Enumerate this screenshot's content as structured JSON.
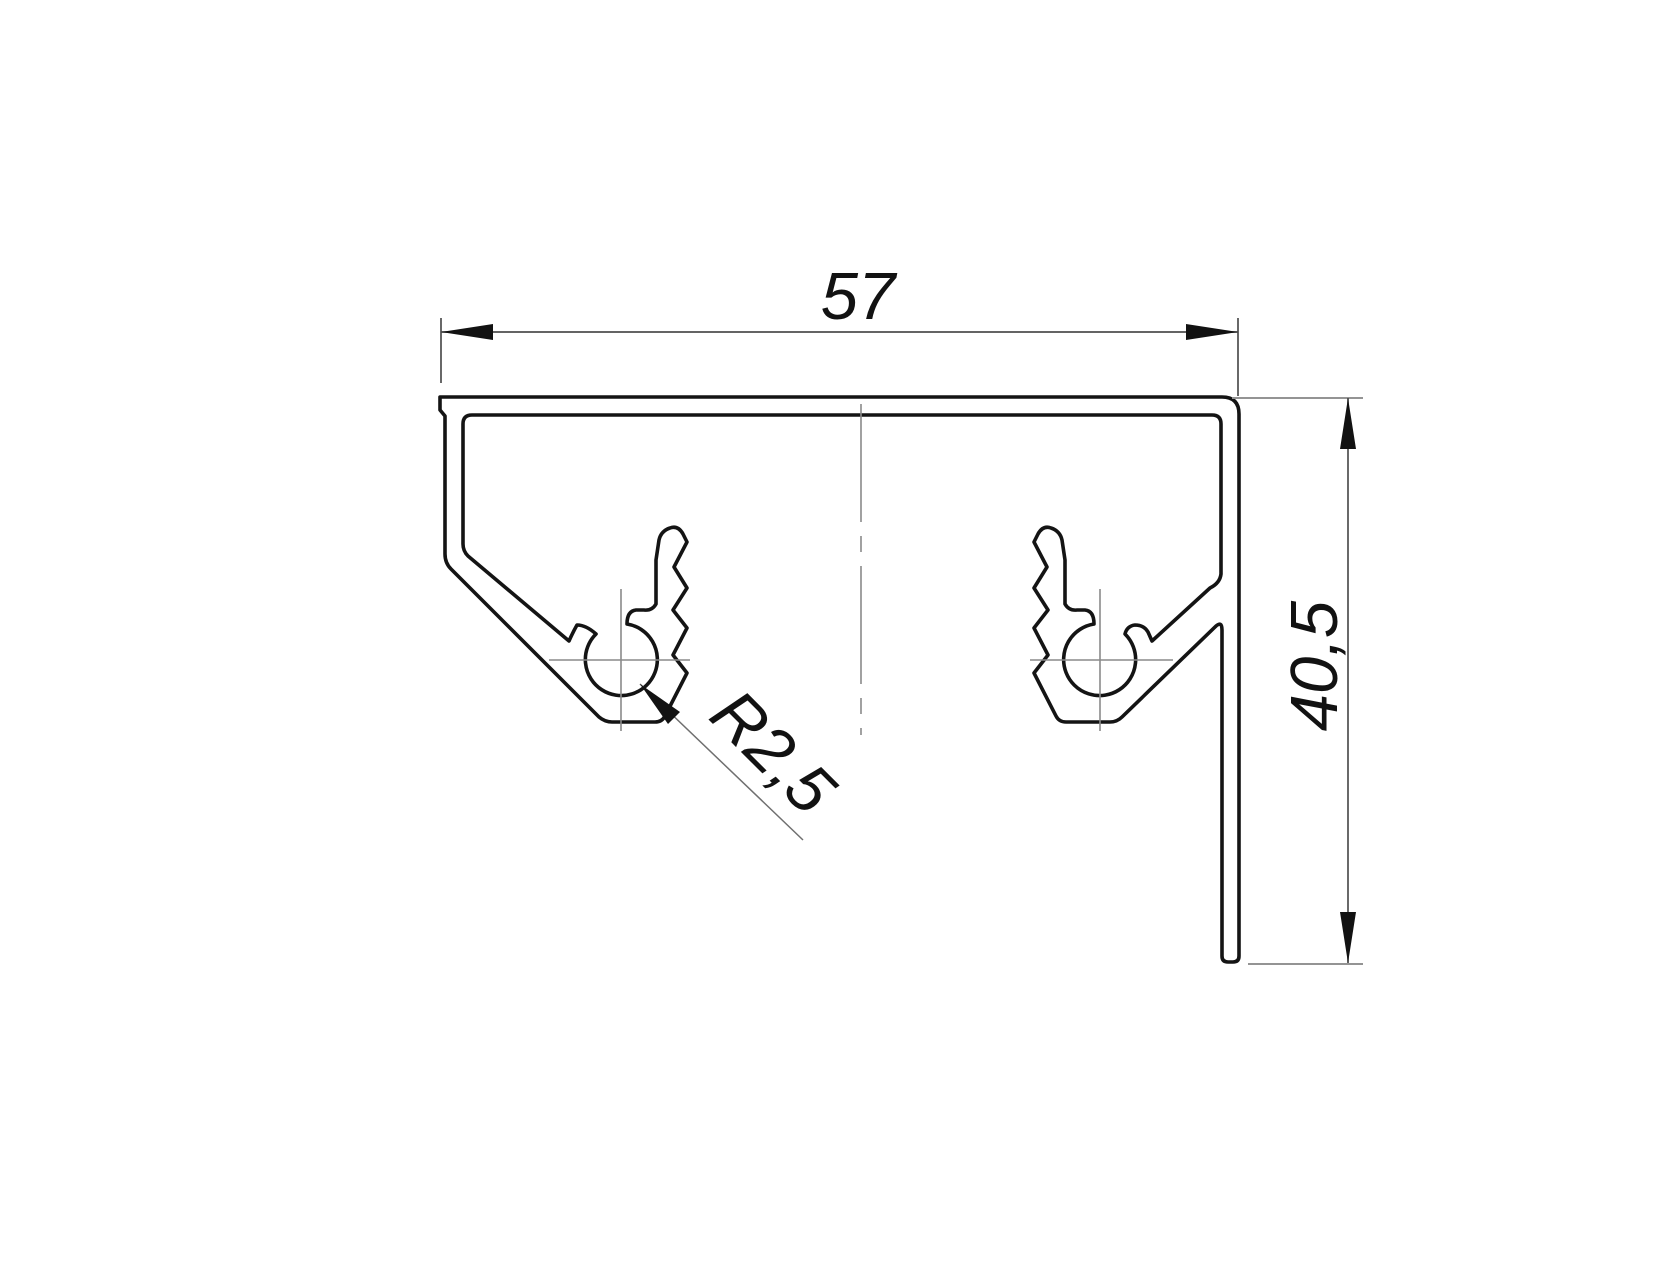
{
  "page": {
    "background": "#ffffff",
    "description": "Technical CAD drawing of an aluminium profile cross-section with two screw bosses, a top plate, a slanted left wall and a vertical right leg"
  },
  "colors": {
    "profile_line": "#141414",
    "dimension_line": "#4f4f4f",
    "extension_line_gray": "#949494",
    "centerline": "#8a8a8a",
    "arrow": "#121212",
    "text": "#121212"
  },
  "labels": {
    "width": "57",
    "height": "40,5",
    "radius": "R2,5"
  },
  "geometry": {
    "profile_path": "M 440 397 L 1222 397 Q 1239 397 1239 414 L 1239 956 Q 1239 962 1233 962 L 1228 962 Q 1222 962 1222 956 L 1222 630 Q 1222 620 1215 627 L 1122 717 Q 1117 722 1110 722 L 1066 722 Q 1059 722 1056 716 L 1034 673 L 1048 655 L 1034 628 L 1048 610 L 1034 588 L 1047 567 L 1034 542 L 1038 534 Q 1043 525 1051 528 Q 1060 531 1062 540 L 1065 560 L 1065 604 Q 1069 611 1077 610 L 1085 610 Q 1094 611 1094 624 A 36 36 0 1 0 1125 634 Q 1127 626 1135 625 Q 1144 625 1148 632 L 1152 641 L 1210 588 Q 1220 583 1221 574 L 1221 424 Q 1221 415 1212 415 L 472 415 Q 463 415 463 424 L 463 544 Q 463 551 468 556 L 569 641 Q 573 632 577 625 Q 586 625 596 634 A 36 36 0 1 0 627 624 Q 627 611 636 610 L 644 610 Q 652 611 656 604 L 656 560 L 659 540 Q 661 531 670 528 Q 678 525 683 534 L 687 542 L 674 567 L 687 588 L 673 610 L 687 628 L 673 655 L 687 673 L 665 716 Q 662 722 655 722 L 612 722 Q 605 722 599 717 L 451 569 Q 445 563 445 554 L 445 416 L 440 410 Z",
    "center_axis_path": "M 861 404 L 861 735",
    "boss_crosshairs_path": "M 621 589 L 621 731 M 549 660 L 690 660 M 1100 589 L 1100 731 M 1030 660 L 1173 660",
    "width_dim_path": "M 441 318 L 441 383 M 1238 318 L 1238 396 M 441 332 L 1238 332",
    "width_arrows_path": "M 441 332 L 493 324 L 493 340 Z M 1238 332 L 1186 324 L 1186 340 Z",
    "height_ext_path": "M 1232 398 L 1363 398 M 1248 964 L 1363 964",
    "height_dim_path": "M 1348 398 L 1348 963",
    "height_arrows_path": "M 1348 398 L 1340 449 L 1356 449 Z M 1348 963 L 1340 912 L 1356 912 Z",
    "radius_leader_path": "M 640 684 L 803 840",
    "radius_arrow_path": "M 640 684 L 680 712 L 668 724 Z"
  }
}
